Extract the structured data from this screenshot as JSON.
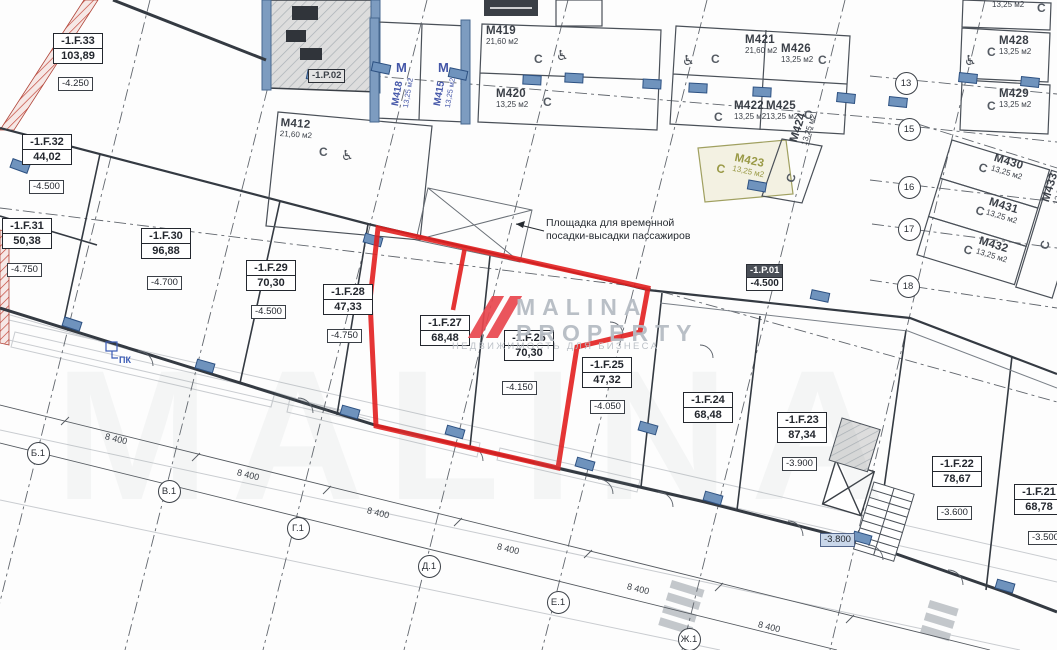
{
  "watermark": {
    "line1": "MALINA",
    "line2": "PROPERTY",
    "tagline": "НЕДВИЖИМОСТЬ ДЛЯ БИЗНЕСА"
  },
  "annotation": {
    "line1": "Площадка для временной",
    "line2": "посадки-высадки пассажиров"
  },
  "fire_cabinet": {
    "label": "ПК"
  },
  "units": [
    {
      "id": "-1.F.33",
      "area": "103,89",
      "x": 53,
      "y": 33,
      "elev": "-4.250",
      "ex": 58,
      "ey": 77
    },
    {
      "id": "-1.F.32",
      "area": "44,02",
      "x": 22,
      "y": 134,
      "elev": "-4.500",
      "ex": 29,
      "ey": 180
    },
    {
      "id": "-1.F.31",
      "area": "50,38",
      "x": 2,
      "y": 218,
      "elev": "-4.750",
      "ex": 7,
      "ey": 263
    },
    {
      "id": "-1.F.30",
      "area": "96,88",
      "x": 141,
      "y": 228,
      "elev": "-4.700",
      "ex": 147,
      "ey": 276
    },
    {
      "id": "-1.F.29",
      "area": "70,30",
      "x": 246,
      "y": 260,
      "elev": "-4.500",
      "ex": 251,
      "ey": 305
    },
    {
      "id": "-1.F.28",
      "area": "47,33",
      "x": 323,
      "y": 284,
      "elev": "-4.750",
      "ex": 327,
      "ey": 329
    },
    {
      "id": "-1.F.27",
      "area": "68,48",
      "x": 420,
      "y": 315,
      "elev": null
    },
    {
      "id": "-1.F.26",
      "area": "70,30",
      "x": 504,
      "y": 330,
      "elev": "-4.150",
      "ex": 502,
      "ey": 381
    },
    {
      "id": "-1.F.25",
      "area": "47,32",
      "x": 582,
      "y": 357,
      "elev": "-4.050",
      "ex": 590,
      "ey": 400
    },
    {
      "id": "-1.F.24",
      "area": "68,48",
      "x": 683,
      "y": 392,
      "elev": null
    },
    {
      "id": "-1.F.23",
      "area": "87,34",
      "x": 777,
      "y": 412,
      "elev": "-3.900",
      "ex": 782,
      "ey": 457
    },
    {
      "id": "-1.F.22",
      "area": "78,67",
      "x": 932,
      "y": 456,
      "elev": "-3.600",
      "ex": 937,
      "ey": 506
    },
    {
      "id": "-1.F.21",
      "area": "68,78",
      "x": 1014,
      "y": 484,
      "elev": "-3.500",
      "ex": 1028,
      "ey": 531
    }
  ],
  "tech_rooms": [
    {
      "id": "-1.P.01",
      "elev": "-4.500",
      "x": 746,
      "y": 264,
      "inverse": true
    },
    {
      "id": "-1.P.02",
      "elev": null,
      "x": 308,
      "y": 69,
      "inverse": false
    }
  ],
  "extra_elevations": [
    {
      "label": "-3.800",
      "x": 820,
      "y": 533,
      "highlight": true
    }
  ],
  "parking": [
    {
      "id": "М412",
      "area": "21,60 м2",
      "x": 281,
      "y": 117,
      "rot": 4,
      "cx": 319,
      "cy": 145,
      "crot": 0,
      "olive": false
    },
    {
      "id": "М419",
      "area": "21,60 м2",
      "x": 486,
      "y": 25,
      "rot": 0,
      "cx": 534,
      "cy": 52,
      "crot": 0,
      "olive": false
    },
    {
      "id": "М420",
      "area": "13,25 м2",
      "x": 496,
      "y": 88,
      "rot": 0,
      "cx": 543,
      "cy": 95,
      "crot": 0,
      "olive": false
    },
    {
      "id": "М421",
      "area": "21,60 м2",
      "x": 745,
      "y": 34,
      "rot": 0,
      "cx": 711,
      "cy": 52,
      "crot": 0,
      "olive": false
    },
    {
      "id": "М426",
      "area": "13,25 м2",
      "x": 781,
      "y": 43,
      "rot": 0,
      "cx": 818,
      "cy": 53,
      "crot": 0,
      "olive": false
    },
    {
      "id": "М422",
      "area": "13,25 м2",
      "x": 734,
      "y": 100,
      "rot": 0,
      "cx": 714,
      "cy": 110,
      "crot": 0,
      "olive": false
    },
    {
      "id": "М425",
      "area": "13,25 м2",
      "x": 766,
      "y": 100,
      "rot": 0,
      "cx": 804,
      "cy": 108,
      "crot": 0,
      "olive": false
    },
    {
      "id": "М423",
      "area": "13,25 м2",
      "x": 736,
      "y": 152,
      "rot": 12,
      "cx": 718,
      "cy": 161,
      "crot": 12,
      "olive": true
    },
    {
      "id": "М424",
      "area": "13,25 м2",
      "x": 788,
      "y": 140,
      "rot": -72,
      "cx": 783,
      "cy": 180,
      "crot": -72,
      "olive": false
    },
    {
      "id": null,
      "area": "13,25 м2",
      "x": 992,
      "y": 0,
      "rot": 0,
      "cx": 1037,
      "cy": 1,
      "crot": 0,
      "olive": false
    },
    {
      "id": "М428",
      "area": "13,25 м2",
      "x": 999,
      "y": 35,
      "rot": 0,
      "cx": 987,
      "cy": 45,
      "crot": 0,
      "olive": false
    },
    {
      "id": "М429",
      "area": "13,25 м2",
      "x": 999,
      "y": 88,
      "rot": 0,
      "cx": 987,
      "cy": 99,
      "crot": 0,
      "olive": false
    },
    {
      "id": "М430",
      "area": "13,25 м2",
      "x": 996,
      "y": 152,
      "rot": 17,
      "cx": 981,
      "cy": 160,
      "crot": 17,
      "olive": false
    },
    {
      "id": "М431",
      "area": "13,25 м2",
      "x": 991,
      "y": 196,
      "rot": 17,
      "cx": 978,
      "cy": 203,
      "crot": 17,
      "olive": false
    },
    {
      "id": "М432",
      "area": "13,25 м2",
      "x": 981,
      "y": 235,
      "rot": 17,
      "cx": 966,
      "cy": 242,
      "crot": 17,
      "olive": false
    },
    {
      "id": "М433",
      "area": "13,25 м2",
      "x": 1040,
      "y": 200,
      "rot": -73,
      "cx": 1037,
      "cy": 247,
      "crot": -73,
      "olive": false
    }
  ],
  "vertical_stalls": [
    {
      "id": "М418",
      "area": "13,25 м2",
      "x": 390,
      "y": 105,
      "rot": -80
    },
    {
      "id": "М415",
      "area": "13,25 м2",
      "x": 432,
      "y": 105,
      "rot": -80
    }
  ],
  "stall_letters": [
    {
      "label": "М",
      "x": 396,
      "y": 60
    },
    {
      "label": "М",
      "x": 438,
      "y": 60
    }
  ],
  "wheelchairs": [
    {
      "x": 341,
      "y": 148
    },
    {
      "x": 556,
      "y": 48
    },
    {
      "x": 682,
      "y": 53
    },
    {
      "x": 964,
      "y": 53
    }
  ],
  "grid": {
    "right": [
      {
        "label": "13",
        "x": 905,
        "y": 82
      },
      {
        "label": "15",
        "x": 908,
        "y": 128
      },
      {
        "label": "16",
        "x": 908,
        "y": 186
      },
      {
        "label": "17",
        "x": 908,
        "y": 228
      },
      {
        "label": "18",
        "x": 907,
        "y": 285
      }
    ],
    "bottom": [
      {
        "label": "Б.1",
        "x": 37,
        "y": 452
      },
      {
        "label": "В.1",
        "x": 168,
        "y": 490
      },
      {
        "label": "Г.1",
        "x": 297,
        "y": 527
      },
      {
        "label": "Д.1",
        "x": 428,
        "y": 565
      },
      {
        "label": "Е.1",
        "x": 557,
        "y": 601
      },
      {
        "label": "Ж.1",
        "x": 688,
        "y": 638
      }
    ]
  },
  "dims": {
    "label": "8 400",
    "rot": 14,
    "positions": [
      [
        104,
        443
      ],
      [
        236,
        479
      ],
      [
        366,
        517
      ],
      [
        496,
        553
      ],
      [
        626,
        593
      ],
      [
        757,
        631
      ]
    ]
  }
}
